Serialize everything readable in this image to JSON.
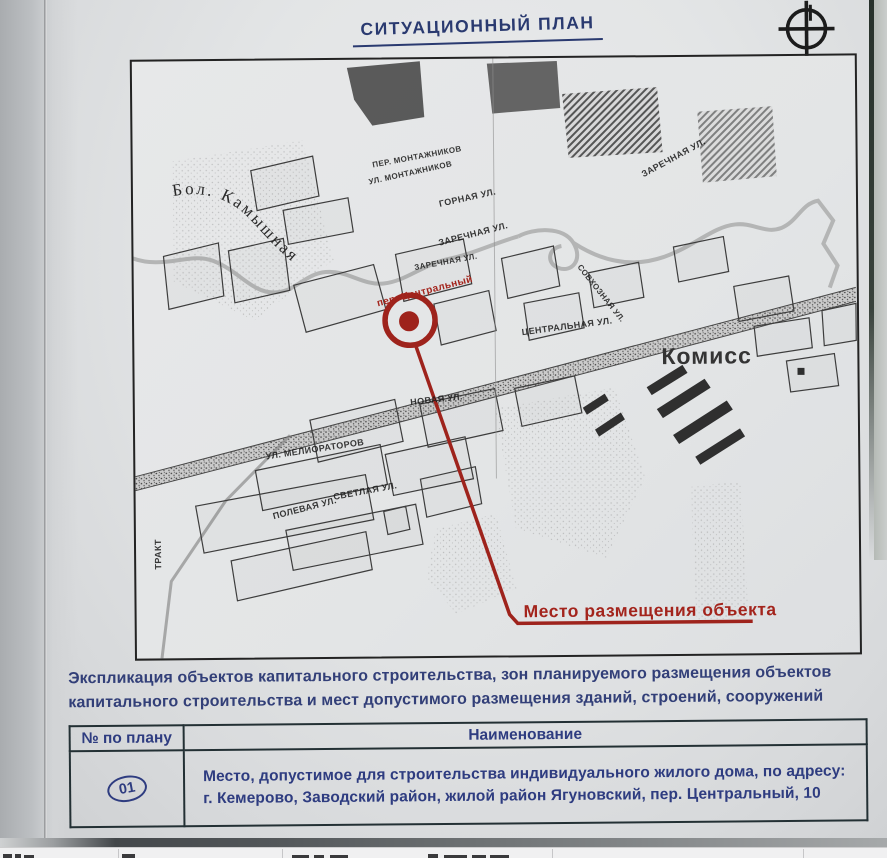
{
  "page": {
    "title": "СИТУАЦИОННЫЙ ПЛАН"
  },
  "map": {
    "accent_red": "#a3241c",
    "marker_street_label": "пер. Центральный",
    "callout_label": "Место размещения объекта",
    "river_label": "Бол. Камышная",
    "district_label": "Комисс",
    "street_labels": [
      {
        "text": "ПЕР. МОНТАЖНИКОВ",
        "x": 239,
        "y": 101,
        "r": -10,
        "s": 8
      },
      {
        "text": "УЛ. МОНТАЖНИКОВ",
        "x": 235,
        "y": 118,
        "r": -12,
        "s": 8
      },
      {
        "text": "ГОРНАЯ УЛ.",
        "x": 305,
        "y": 140,
        "r": -12,
        "s": 9
      },
      {
        "text": "ЗАРЕЧНАЯ УЛ.",
        "x": 304,
        "y": 179,
        "r": -14,
        "s": 9
      },
      {
        "text": "ЗАРЕЧНАЯ УЛ.",
        "x": 280,
        "y": 204,
        "r": -10,
        "s": 8
      },
      {
        "text": "ЗАРЕЧНАЯ УЛ.",
        "x": 507,
        "y": 113,
        "r": -28,
        "s": 9
      },
      {
        "text": "ЦЕНТРАЛЬНАЯ УЛ.",
        "x": 387,
        "y": 269,
        "r": -7,
        "s": 9
      },
      {
        "text": "СОВХОЗНАЯ УЛ.",
        "x": 449,
        "y": 205,
        "r": 52,
        "s": 8
      },
      {
        "text": "НОВАЯ УЛ.",
        "x": 275,
        "y": 338,
        "r": -6,
        "s": 9
      },
      {
        "text": "УЛ. МЕЛИОРАТОРОВ",
        "x": 130,
        "y": 391,
        "r": -8,
        "s": 9
      },
      {
        "text": "СВЕТЛАЯ УЛ.",
        "x": 197,
        "y": 432,
        "r": -10,
        "s": 9
      },
      {
        "text": "ПОЛЕВАЯ УЛ.",
        "x": 136,
        "y": 451,
        "r": -14,
        "s": 9
      },
      {
        "text": "ТРАКТ",
        "x": 17,
        "y": 508,
        "r": -90,
        "s": 9
      }
    ]
  },
  "explication": {
    "text": "Экспликация объектов капитального строительства, зон планируемого размещения объектов капитального строительства и мест допустимого размещения зданий, строений, сооружений"
  },
  "table": {
    "col1_header": "№ по плану",
    "col2_header": "Наименование",
    "rows": [
      {
        "num": "01",
        "text": "Место, допустимое для строительства индивидуального жилого дома, по адресу: г. Кемерово, Заводский район, жилой район Ягуновский, пер. Центральный, 10"
      }
    ]
  }
}
